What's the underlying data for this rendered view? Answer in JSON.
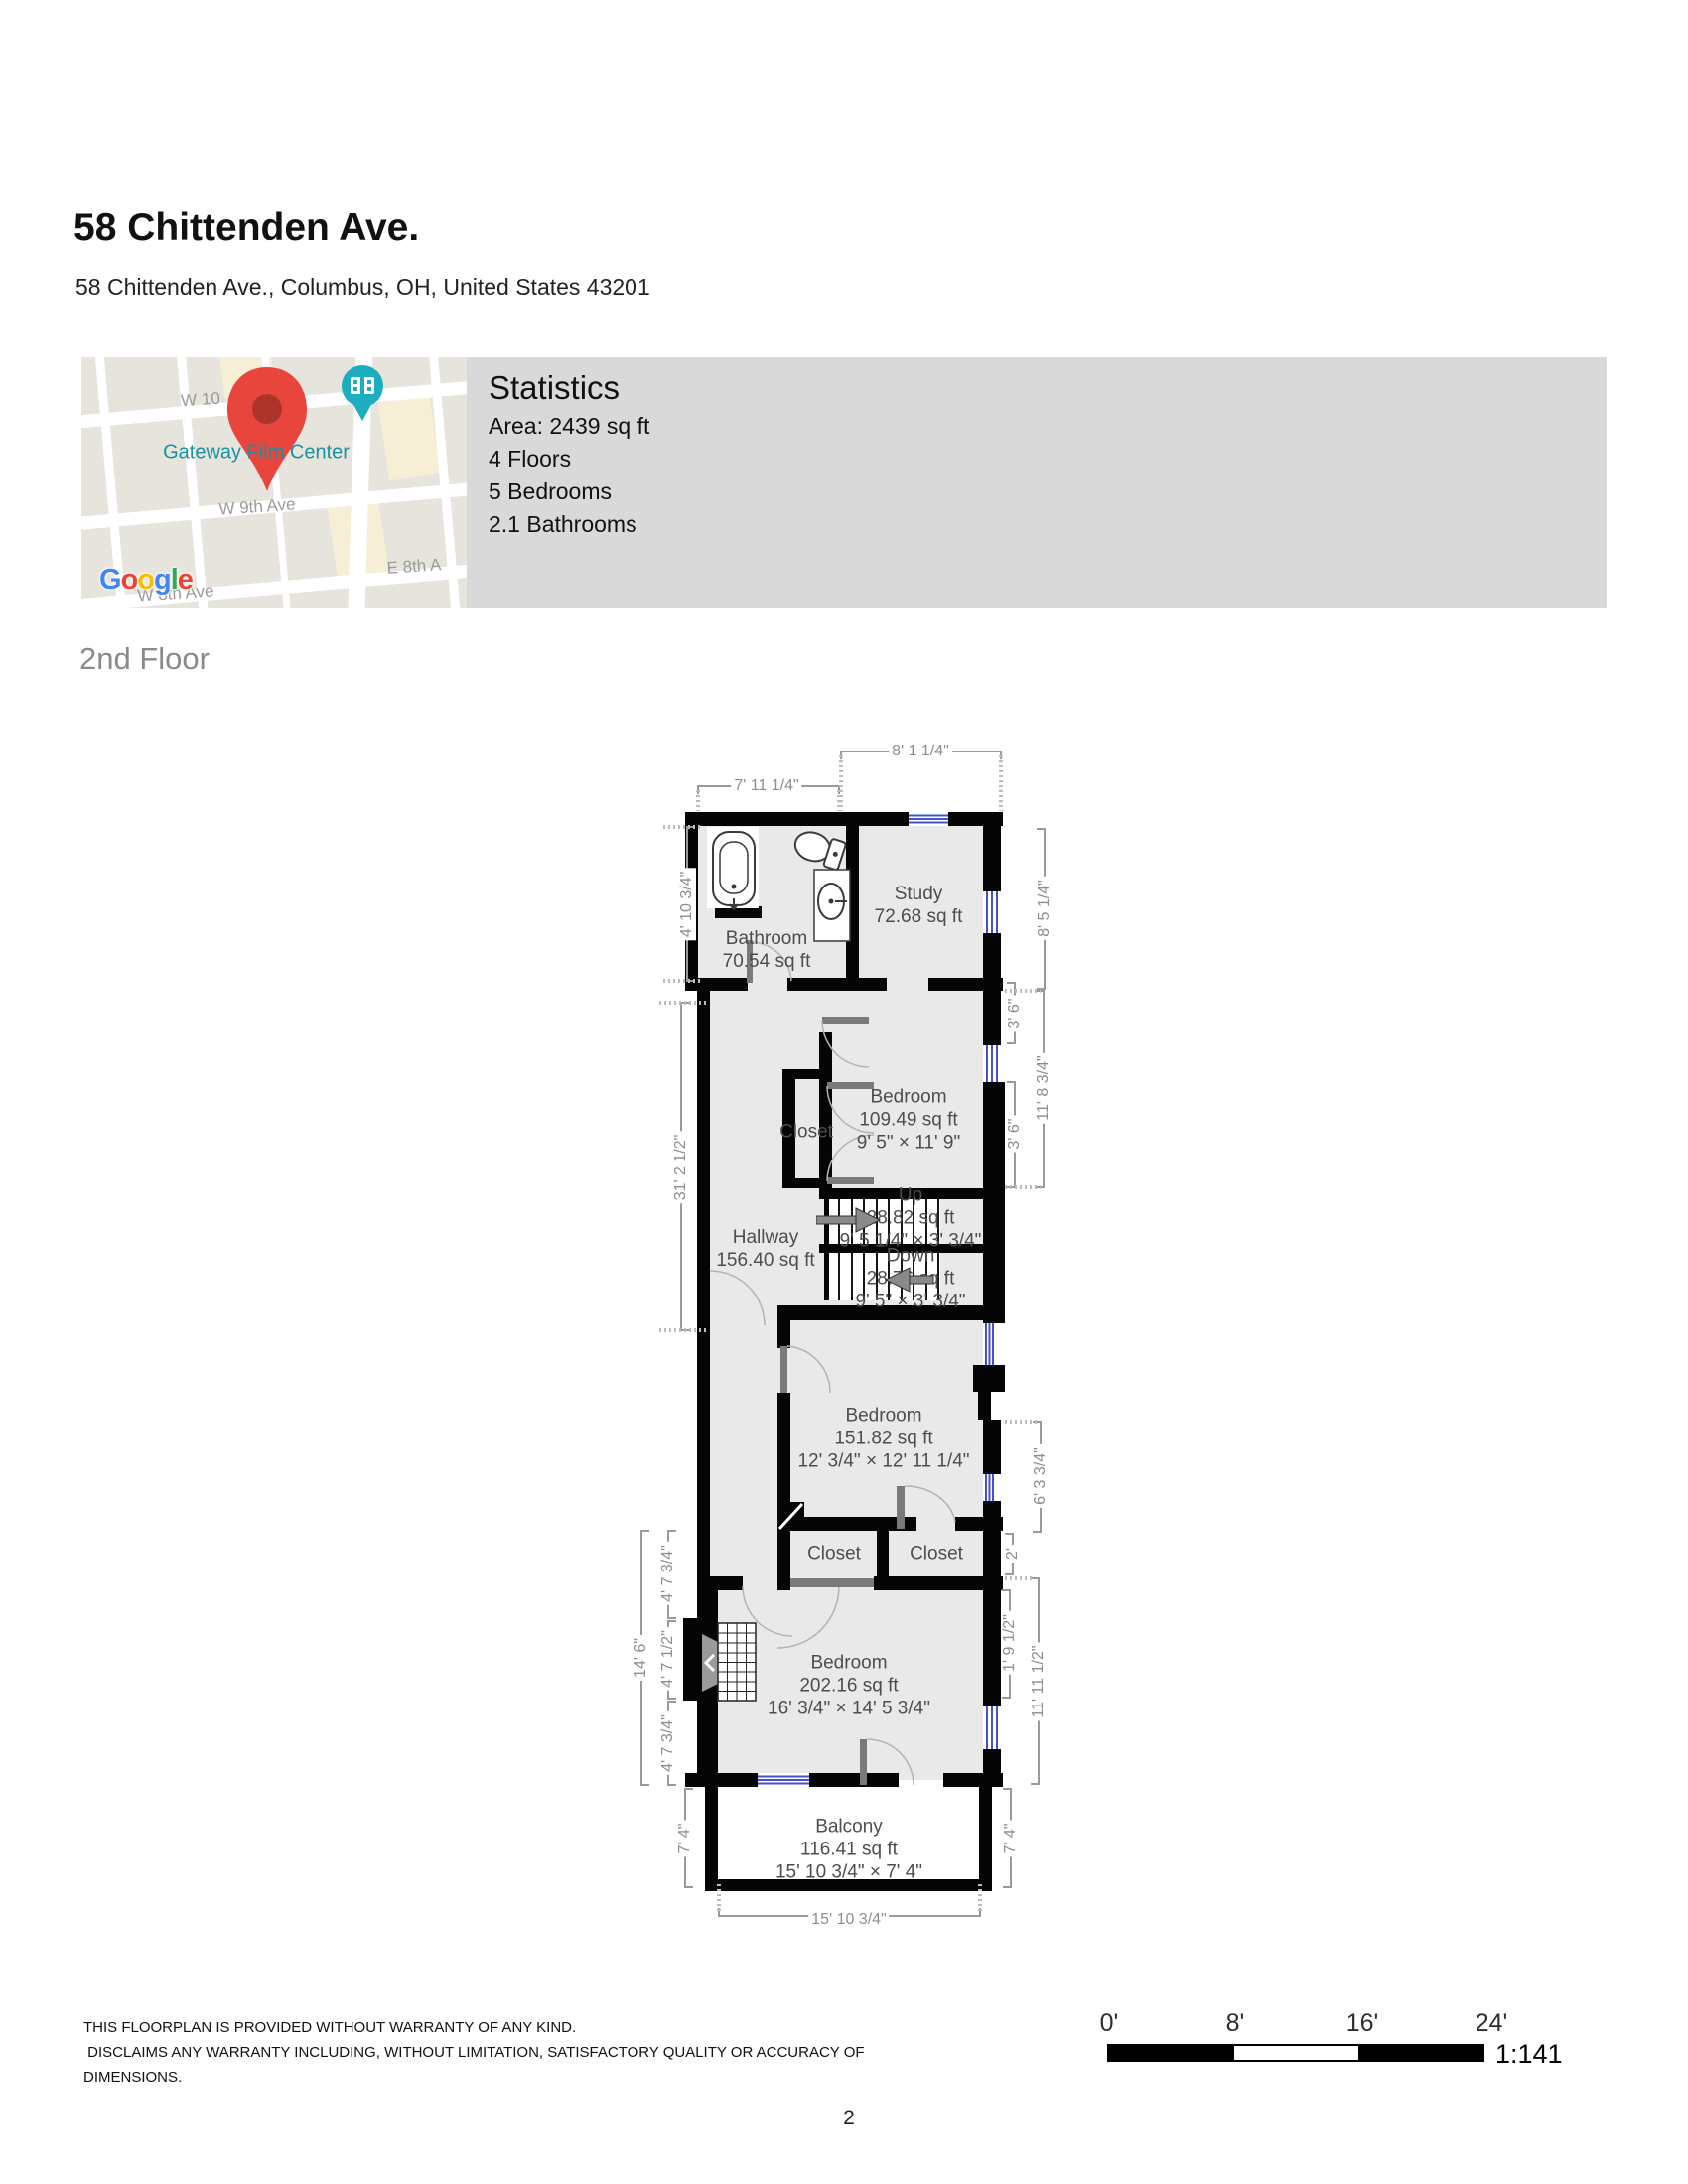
{
  "page": {
    "title": "58 Chittenden Ave.",
    "address": "58 Chittenden Ave., Columbus, OH, United States 43201",
    "floor_heading": "2nd Floor",
    "page_number": "2"
  },
  "map": {
    "labels": {
      "street_w10": "W 10",
      "place": "Gateway Film Center",
      "street_w9": "W 9th Ave",
      "street_e8": "E 8th A",
      "street_w8": "W 8th Ave"
    },
    "attribution_letters": [
      "G",
      "o",
      "o",
      "g",
      "l",
      "e"
    ],
    "colors": {
      "place_label": "#17929f",
      "pin": "#e8463d",
      "poi_marker": "#1caebe"
    }
  },
  "statistics": {
    "heading": "Statistics",
    "items": [
      "Area: 2439 sq ft",
      "4 Floors",
      "5 Bedrooms",
      "2.1 Bathrooms"
    ]
  },
  "plan": {
    "rooms": [
      {
        "name": "Bathroom",
        "area": "70.54 sq ft"
      },
      {
        "name": "Study",
        "area": "72.68 sq ft"
      },
      {
        "name": "Bedroom",
        "area": "109.49 sq ft",
        "dims": "9' 5\" × 11' 9\""
      },
      {
        "name": "Closet"
      },
      {
        "name": "Hallway",
        "area": "156.40 sq ft"
      },
      {
        "name": "Up",
        "area": "28.82 sq ft",
        "dims": "9' 5 1/4\" × 3' 3/4\""
      },
      {
        "name": "Down",
        "area": "28.76 sq ft",
        "dims": "9' 5\" × 3' 3/4\""
      },
      {
        "name": "Bedroom",
        "area": "151.82 sq ft",
        "dims": "12' 3/4\" × 12' 11 1/4\""
      },
      {
        "name": "Closet"
      },
      {
        "name": "Closet"
      },
      {
        "name": "Bedroom",
        "area": "202.16 sq ft",
        "dims": "16' 3/4\" × 14' 5 3/4\""
      },
      {
        "name": "Balcony",
        "area": "116.41 sq ft",
        "dims": "15' 10 3/4\" × 7' 4\""
      }
    ],
    "dimensions": {
      "top": [
        "8' 1 1/4\"",
        "7' 11 1/4\""
      ],
      "left": [
        "4' 10 3/4\"",
        "31' 2 1/2\"",
        "14' 6\"",
        "4' 7 3/4\"",
        "4' 7 1/2\"",
        "4' 7 3/4\"",
        "7' 4\""
      ],
      "right": [
        "8' 5 1/4\"",
        "3' 6\"",
        "11' 8 3/4\"",
        "3' 6\"",
        "6' 3 3/4\"",
        "2'",
        "1' 9 1/2\"",
        "11' 11 1/2\"",
        "7' 4\""
      ],
      "bottom": [
        "15' 10 3/4\""
      ]
    },
    "window_color": "#4353cb"
  },
  "footer": {
    "lines": [
      "THIS FLOORPLAN IS PROVIDED WITHOUT WARRANTY OF ANY KIND.",
      " DISCLAIMS ANY WARRANTY INCLUDING, WITHOUT LIMITATION, SATISFACTORY QUALITY OR ACCURACY OF",
      "DIMENSIONS."
    ]
  },
  "scalebar": {
    "ticks": [
      "0'",
      "8'",
      "16'",
      "24'"
    ],
    "ratio": "1:141"
  }
}
